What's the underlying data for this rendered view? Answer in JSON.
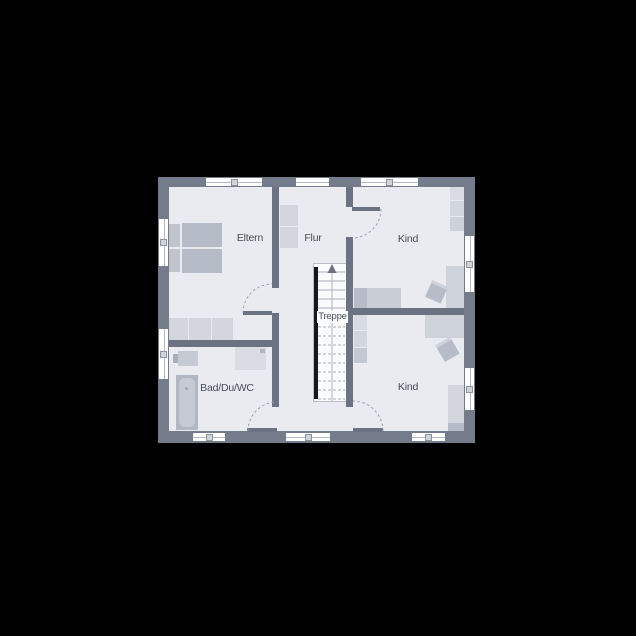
{
  "canvas": {
    "background": "#000000"
  },
  "floorplan": {
    "colors": {
      "floor": "#e9ebf0",
      "exterior_wall": "#747c8b",
      "interior_wall": "#6b7382",
      "furniture_light": "#d3d6dd",
      "furniture_dark": "#b5bbc7",
      "stairwell": "#fafbfd",
      "label_text": "#474d58"
    },
    "rooms": [
      {
        "id": "eltern",
        "label": "Eltern"
      },
      {
        "id": "flur",
        "label": "Flur"
      },
      {
        "id": "kind_top",
        "label": "Kind"
      },
      {
        "id": "kind_bottom",
        "label": "Kind"
      },
      {
        "id": "bad",
        "label": "Bad/Du/WC"
      },
      {
        "id": "treppe",
        "label": "Treppe"
      }
    ]
  }
}
